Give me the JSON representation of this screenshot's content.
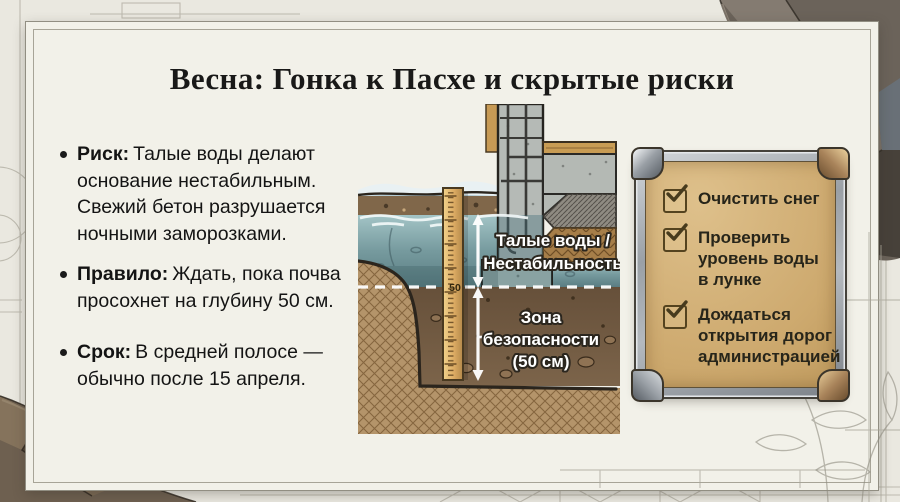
{
  "title": "Весна: Гонка к Пасхе и скрытые риски",
  "bullets": [
    {
      "label": "Риск:",
      "text": "Талые воды делают основание нестабильным. Свежий бетон разрушается ночными заморозками."
    },
    {
      "label": "Правило:",
      "text": "Ждать, пока почва просохнет на глубину 50 см."
    },
    {
      "label": "Срок:",
      "text": "В средней полосе — обычно после 15 апреля."
    }
  ],
  "diagram": {
    "water_label_1": "Талые воды /",
    "water_label_2": "Нестабильность",
    "zone_label_1": "Зона",
    "zone_label_2": "безопасности",
    "zone_label_3": "(50 см)",
    "ruler_mark": "50"
  },
  "checklist": {
    "items": [
      {
        "label": "Очистить снег",
        "checked": true
      },
      {
        "label": "Проверить уровень воды в лунке",
        "checked": true
      },
      {
        "label": "Дождаться открытия дорог администрацией",
        "checked": true
      }
    ]
  },
  "colors": {
    "paper": "#f2f1e9",
    "water": "#769a9e",
    "soil": "#6b553c",
    "plaque_tan": "#cda96e",
    "metal": "#9aa0a6",
    "rock_dark": "#4a443c"
  }
}
